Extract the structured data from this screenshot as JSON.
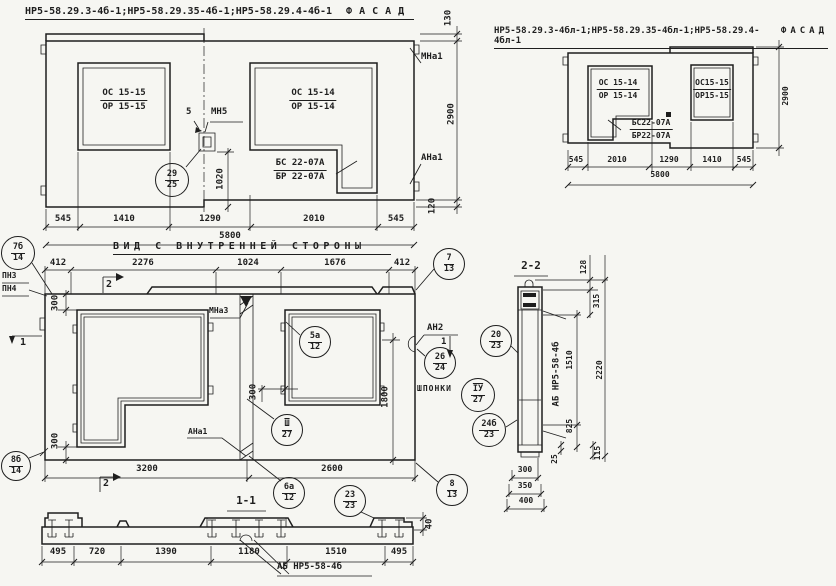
{
  "colors": {
    "ink": "#1e1e1e",
    "paper": "#f6f6f2"
  },
  "titles": {
    "left_code": "НР5-58.29.3-4б-1;НР5-58.29.35-4б-1;НР5-58.29.4-4б-1",
    "left_name": "ФАСАД",
    "right_code": "НР5-58.29.3-4бл-1;НР5-58.29.35-4бл-1;НР5-58.29.4-4бл-1",
    "right_name": "ФАСАД",
    "inner": "ВИД С ВНУТРЕННЕЙ СТОРОНЫ",
    "sec11": "1-1",
    "sec22": "2-2"
  },
  "facade_left": {
    "win1_top": "ОС 15-15",
    "win1_bot": "ОР 15-15",
    "win2_top": "ОС 15-14",
    "win2_bot": "ОР 15-14",
    "sill_top": "БС 22-07А",
    "sill_bot": "БР 22-07А",
    "pos": "5",
    "mn5": "МН5",
    "mna1": "МНа1",
    "ana1": "АНа1",
    "d1020": "1020",
    "d130": "130",
    "d2900": "2900",
    "d120": "120",
    "dims": [
      "545",
      "1410",
      "1290",
      "2010",
      "545"
    ],
    "total": "5800"
  },
  "facade_right": {
    "win1_top": "ОС 15-14",
    "win1_bot": "ОР 15-14",
    "win2_top": "ОС15-15",
    "win2_bot": "ОР15-15",
    "sill_top": "БС22-07А",
    "sill_bot": "БР22-07А",
    "dims": [
      "545",
      "2010",
      "1290",
      "1410",
      "545"
    ],
    "total": "5800",
    "d2900": "2900"
  },
  "inner": {
    "top_dims": [
      "412",
      "2276",
      "1024",
      "1676",
      "412"
    ],
    "pn3": "ПН3",
    "pn4": "ПН4",
    "mna3": "МНа3",
    "ana1": "АНа1",
    "an2": "АН2",
    "an2_pos": "1",
    "shponki": "ШПОНКИ",
    "d300_top": "300",
    "d300_mid": "300",
    "d300_bot": "300",
    "d1800": "1800",
    "d3200": "3200",
    "d2600": "2600",
    "mark1": "1",
    "mark2_top": "2",
    "mark2_bot": "2"
  },
  "callouts": {
    "c29": {
      "t": "29",
      "b": "25"
    },
    "c7": {
      "t": "7",
      "b": "13"
    },
    "c7b": {
      "t": "7б",
      "b": "14"
    },
    "c5a": {
      "t": "5а",
      "b": "12"
    },
    "c3": {
      "t": "Ш",
      "b": "27"
    },
    "c26": {
      "t": "26",
      "b": "24"
    },
    "c4": {
      "t": "ІУ",
      "b": "27"
    },
    "c20": {
      "t": "20",
      "b": "23"
    },
    "c24b": {
      "t": "24б",
      "b": "23"
    },
    "c8b": {
      "t": "8б",
      "b": "14"
    },
    "c6a": {
      "t": "6а",
      "b": "12"
    },
    "c8": {
      "t": "8",
      "b": "13"
    },
    "c23": {
      "t": "23",
      "b": "23"
    }
  },
  "sec11": {
    "dims": [
      "495",
      "720",
      "1390",
      "1180",
      "1510",
      "495"
    ],
    "d40": "40",
    "label": "АБ НР5-58-4б"
  },
  "sec22": {
    "label": "АБ НР5-58-4б",
    "d128": "128",
    "d315": "315",
    "d1510": "1510",
    "d825": "825",
    "d25": "25",
    "d115": "115",
    "d2220": "2220",
    "d300": "300",
    "d350": "350",
    "d400": "400"
  }
}
